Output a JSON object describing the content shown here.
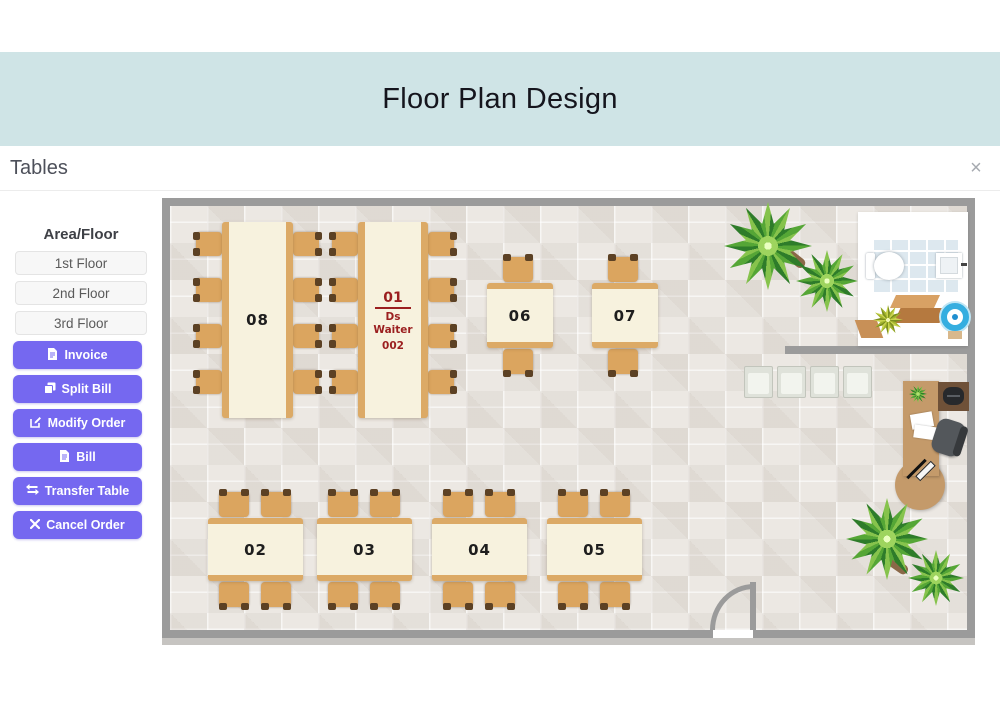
{
  "header": {
    "title": "Floor Plan Design"
  },
  "panel": {
    "title": "Tables",
    "close_glyph": "×",
    "close_icon": "close-icon"
  },
  "sidebar": {
    "area_floor_label": "Area/Floor",
    "floors": [
      {
        "label": "1st Floor"
      },
      {
        "label": "2nd Floor"
      },
      {
        "label": "3rd Floor"
      }
    ],
    "actions": [
      {
        "label": "Invoice",
        "icon": "file-invoice-icon"
      },
      {
        "label": "Split Bill",
        "icon": "copy-icon"
      },
      {
        "label": "Modify Order",
        "icon": "edit-icon"
      },
      {
        "label": "Bill",
        "icon": "file-icon"
      },
      {
        "label": "Transfer Table",
        "icon": "transfer-arrows-icon"
      },
      {
        "label": "Cancel Order",
        "icon": "x-icon"
      }
    ]
  },
  "floorplan": {
    "tables": [
      {
        "id": "08",
        "label": "08",
        "shape": "long-vertical",
        "seats": 8
      },
      {
        "id": "01",
        "label": "01",
        "shape": "long-vertical",
        "seats": 8,
        "waiter": "Ds Waiter",
        "waiter_code": "002",
        "status": "occupied"
      },
      {
        "id": "06",
        "label": "06",
        "shape": "square",
        "seats": 2
      },
      {
        "id": "07",
        "label": "07",
        "shape": "square",
        "seats": 2
      },
      {
        "id": "02",
        "label": "02",
        "shape": "rect-horizontal",
        "seats": 4
      },
      {
        "id": "03",
        "label": "03",
        "shape": "rect-horizontal",
        "seats": 4
      },
      {
        "id": "04",
        "label": "04",
        "shape": "rect-horizontal",
        "seats": 4
      },
      {
        "id": "05",
        "label": "05",
        "shape": "rect-horizontal",
        "seats": 4
      }
    ]
  },
  "colors": {
    "accent_purple": "#7568f0",
    "banner_teal": "#cfe4e6",
    "occupied_table_text": "#9b1f1f",
    "wall_gray": "#9b9b9b"
  }
}
